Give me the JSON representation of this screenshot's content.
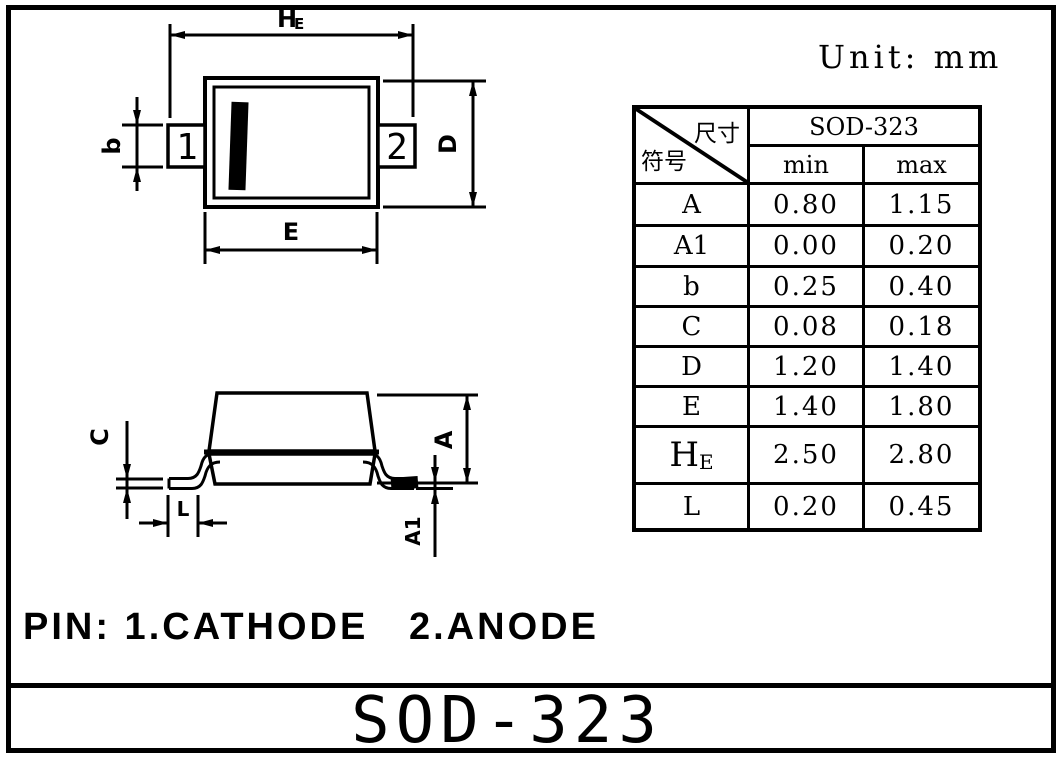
{
  "unit_label": "Unit: mm",
  "title": "SOD-323",
  "pin_note": "PIN: 1.CATHODE   2.ANODE",
  "top_view": {
    "pin1": "1",
    "pin2": "2",
    "dim_he_main": "H",
    "dim_he_sub": "E",
    "dim_b": "b",
    "dim_d": "D",
    "dim_e": "E"
  },
  "side_view": {
    "dim_c": "C",
    "dim_l": "L",
    "dim_a": "A",
    "dim_a1": "A1"
  },
  "table": {
    "corner_top_right": "尺寸",
    "corner_bottom_left": "符号",
    "package_name": "SOD-323",
    "col_min": "min",
    "col_max": "max",
    "rows": [
      {
        "symbol": "A",
        "min": "0.80",
        "max": "1.15"
      },
      {
        "symbol": "A1",
        "min": "0.00",
        "max": "0.20"
      },
      {
        "symbol": "b",
        "min": "0.25",
        "max": "0.40"
      },
      {
        "symbol": "C",
        "min": "0.08",
        "max": "0.18"
      },
      {
        "symbol": "D",
        "min": "1.20",
        "max": "1.40"
      },
      {
        "symbol": "E",
        "min": "1.40",
        "max": "1.80"
      },
      {
        "symbol_main": "H",
        "symbol_sub": "E",
        "min": "2.50",
        "max": "2.80"
      },
      {
        "symbol": "L",
        "min": "0.20",
        "max": "0.45"
      }
    ]
  },
  "colors": {
    "ink": "#000000",
    "paper": "#ffffff"
  }
}
